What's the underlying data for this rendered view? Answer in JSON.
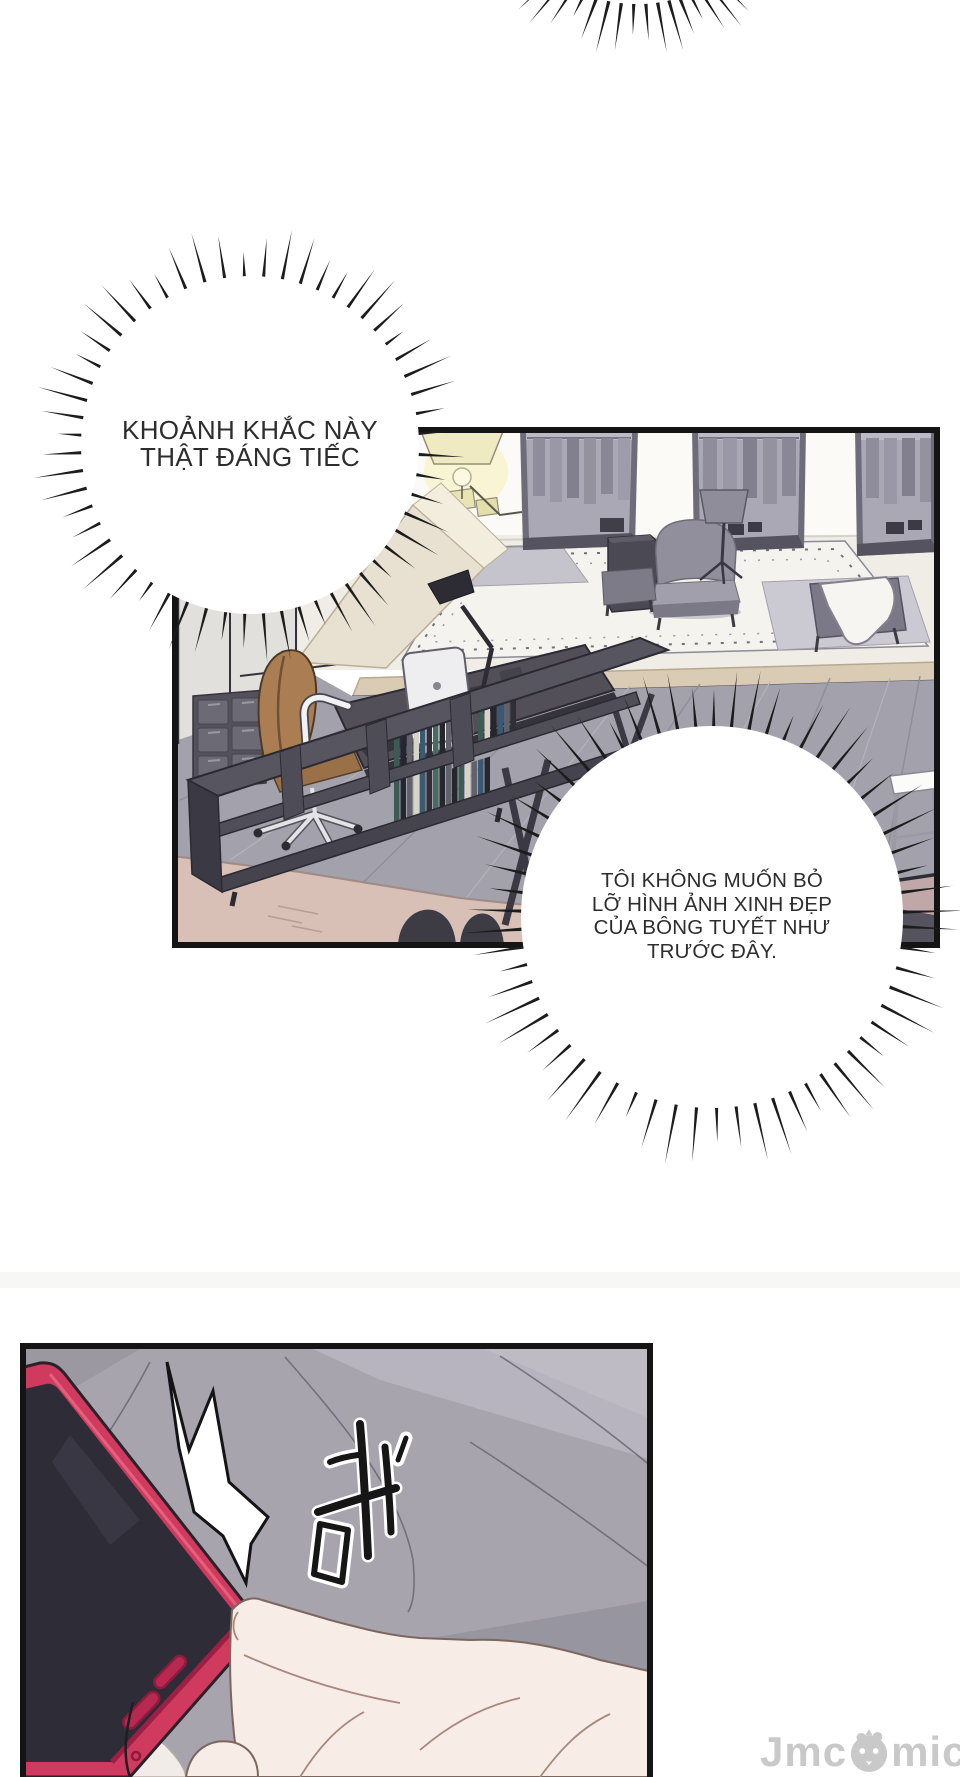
{
  "page": {
    "width": 960,
    "height": 1777,
    "background": "#ffffff"
  },
  "bubbles": {
    "b1": {
      "lines": [
        "KHOẢNH KHẮC NÀY",
        "THẬT ĐÁNG TIẾC"
      ]
    },
    "b2": {
      "lines": [
        "TÔI KHÔNG MUỐN BỎ",
        "LỠ HÌNH ẢNH XINH ĐẸP",
        "CỦA BÔNG TUYẾT NHƯ",
        "TRƯỚC ĐÂY."
      ]
    }
  },
  "sfx": {
    "text": "砬"
  },
  "watermark": {
    "prefix": "Jmc",
    "suffix": "mic",
    "full_text": "Jmcomic",
    "color": "#c9c9c9",
    "mascot_icon": "chick-face-icon"
  },
  "colors": {
    "panel_border": "#141414",
    "spikes": "#1c1c1c",
    "office_floor": "#a3a1ab",
    "bed_fabric": "#a7a4ae",
    "phone_case": "#cf3a5e",
    "phone_screen": "#2e2c37",
    "chair_leather": "#aa7e52",
    "foreground_floor": "#d8c0b7"
  }
}
